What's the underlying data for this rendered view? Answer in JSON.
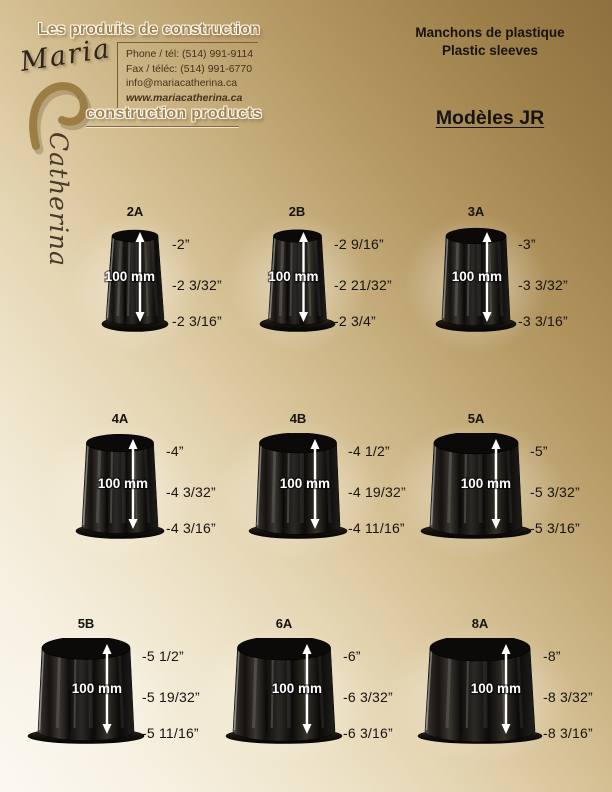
{
  "brand": {
    "name_first": "Maria",
    "name_last": "Catherina",
    "tagline_fr": "Les produits de construction",
    "tagline_en": "construction products",
    "phone": "Phone / tél: (514) 991-9114",
    "fax": "Fax / téléc: (514) 991-6770",
    "email": "info@mariacatherina.ca",
    "website": "www.mariacatherina.ca"
  },
  "titles": {
    "product_fr": "Manchons de plastique",
    "product_en": "Plastic sleeves",
    "model": "Modèles JR"
  },
  "colors": {
    "gold_dark": "#8e7040",
    "gold_heading": "#a5824a",
    "cream": "#fbf9f2",
    "text_dark": "#161310",
    "contact_text": "#46311d"
  },
  "products": [
    {
      "code": "2A",
      "height_label": "100 mm",
      "dims": [
        "-2”",
        "-2 3/32”",
        "-2 3/16”"
      ]
    },
    {
      "code": "2B",
      "height_label": "100 mm",
      "dims": [
        "-2 9/16”",
        "-2 21/32”",
        "-2 3/4”"
      ]
    },
    {
      "code": "3A",
      "height_label": "100 mm",
      "dims": [
        "-3”",
        "-3 3/32”",
        "-3 3/16”"
      ]
    },
    {
      "code": "4A",
      "height_label": "100 mm",
      "dims": [
        "-4”",
        "-4 3/32”",
        "-4 3/16”"
      ]
    },
    {
      "code": "4B",
      "height_label": "100 mm",
      "dims": [
        "-4 1/2”",
        "-4 19/32”",
        "-4 11/16”"
      ]
    },
    {
      "code": "5A",
      "height_label": "100 mm",
      "dims": [
        "-5”",
        "-5 3/32”",
        "-5 3/16”"
      ]
    },
    {
      "code": "5B",
      "height_label": "100 mm",
      "dims": [
        "-5 1/2”",
        "-5 19/32”",
        "-5 11/16”"
      ]
    },
    {
      "code": "6A",
      "height_label": "100 mm",
      "dims": [
        "-6”",
        "-6 3/32”",
        "-6 3/16”"
      ]
    },
    {
      "code": "8A",
      "height_label": "100 mm",
      "dims": [
        "-8”",
        "-8 3/32”",
        "-8 3/16”"
      ]
    }
  ]
}
